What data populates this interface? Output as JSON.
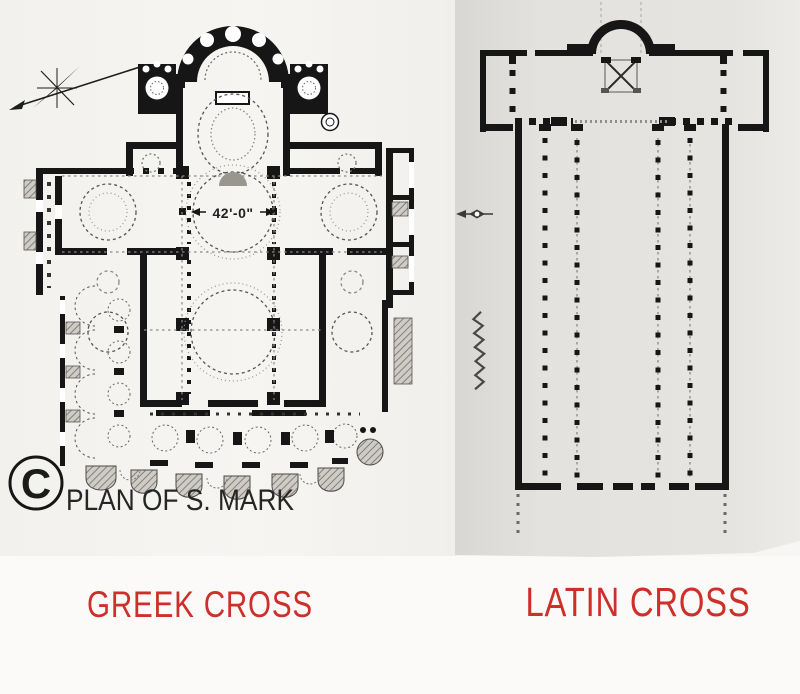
{
  "colors": {
    "page_bg": "#f7f6f4",
    "strip_bg": "#fbfaf8",
    "paper_grey": "#e3e1dd",
    "ink": "#161616",
    "label_red": "#cd302a"
  },
  "left_panel": {
    "label": "GREEK CROSS",
    "plan_caption": "PLAN OF S. MARK",
    "copyright_symbol": "C",
    "dome_dimension": "42'-0\""
  },
  "right_panel": {
    "label": "LATIN CROSS"
  }
}
